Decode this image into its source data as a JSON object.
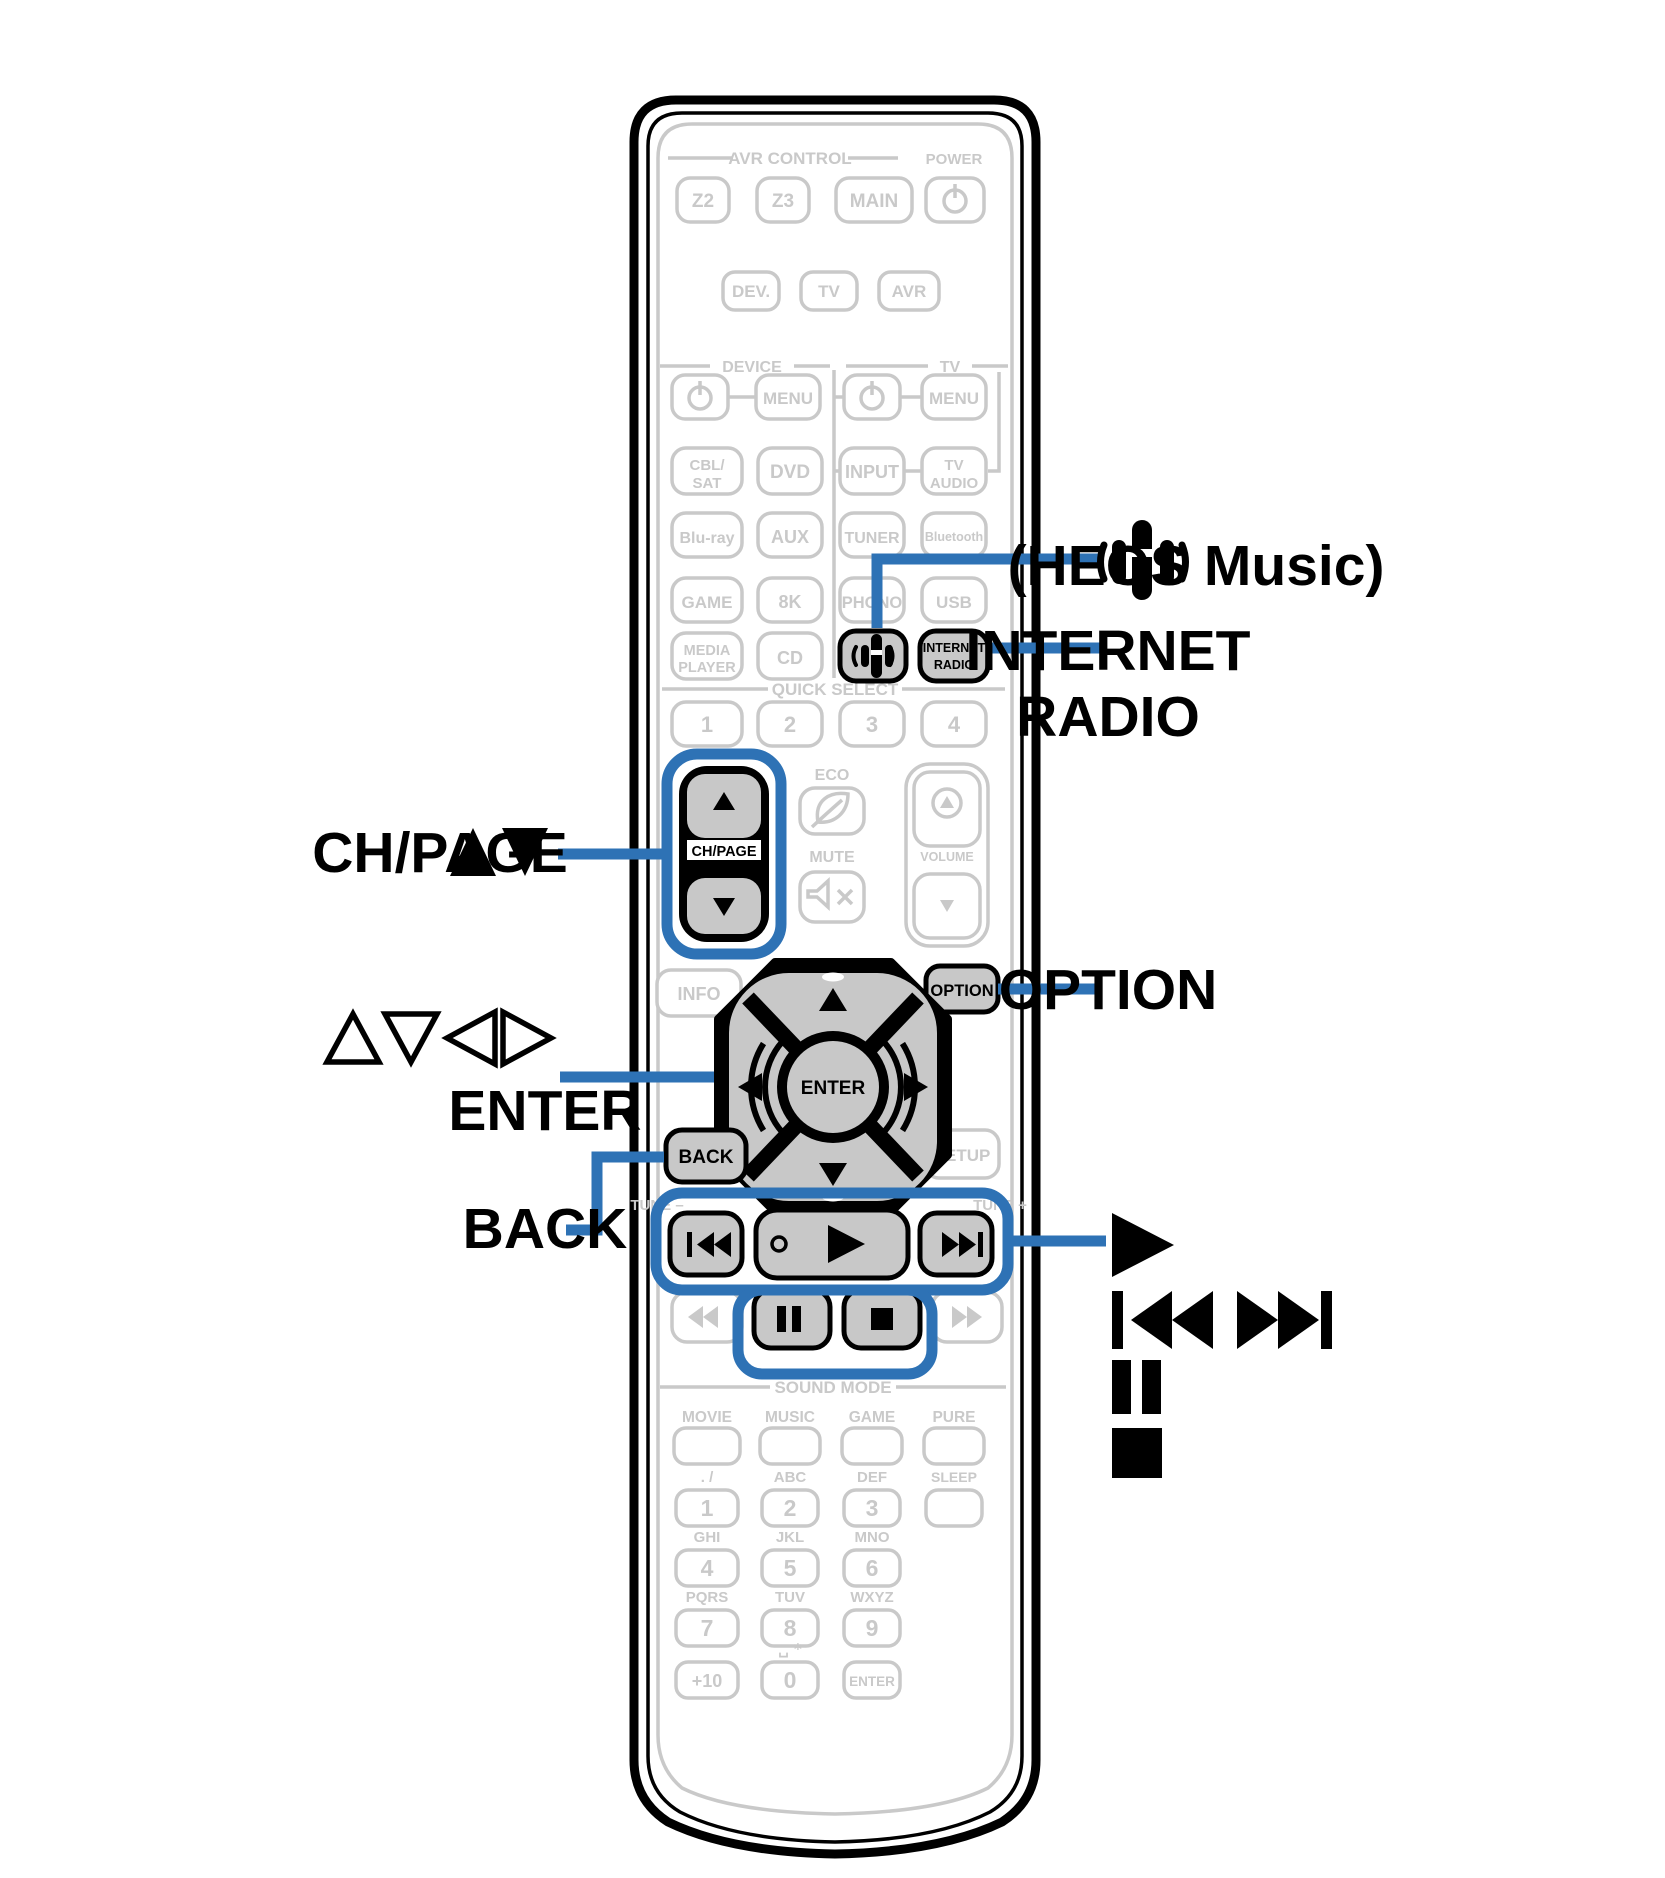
{
  "colors": {
    "accent_blue": "#2E72B5",
    "inactive_gray": "#C9C9C9",
    "key_fill": "#C8C8C8",
    "ink": "#000000"
  },
  "callouts": {
    "ch_page": "CH/PAGE",
    "enter": "ENTER",
    "back": "BACK",
    "heos": "(HEOS Music)",
    "internet_line1": "INTERNET",
    "internet_line2": "RADIO",
    "option": "OPTION"
  },
  "glyphs": {
    "ch_page_arrows": "▲▼",
    "cursor_arrows": "△▽◁▷",
    "play": "▶",
    "skip_back": "⏮",
    "skip_forward": "⏭",
    "pause": "⏸",
    "stop": "⏹"
  },
  "remote": {
    "avr_control": {
      "title": "AVR CONTROL",
      "z2": "Z2",
      "z3": "Z3",
      "main": "MAIN",
      "power": "POWER"
    },
    "mode_buttons": {
      "dev": "DEV.",
      "tv": "TV",
      "avr": "AVR"
    },
    "sections": {
      "device": "DEVICE",
      "tv": "TV"
    },
    "grid": {
      "menu_device": "MENU",
      "menu_tv": "MENU",
      "cbl_line1": "CBL/",
      "cbl_line2": "SAT",
      "dvd": "DVD",
      "input": "INPUT",
      "tv_audio_line1": "TV",
      "tv_audio_line2": "AUDIO",
      "bluray": "Blu-ray",
      "aux": "AUX",
      "tuner": "TUNER",
      "bluetooth": "Bluetooth",
      "game": "GAME",
      "k8": "8K",
      "phono": "PHONO",
      "usb": "USB",
      "media_line1": "MEDIA",
      "media_line2": "PLAYER",
      "cd": "CD",
      "internet_line1": "INTERNET",
      "internet_line2": "RADIO"
    },
    "quick_select": {
      "title": "QUICK SELECT",
      "q1": "1",
      "q2": "2",
      "q3": "3",
      "q4": "4"
    },
    "center": {
      "eco": "ECO",
      "ch_page": "CH/PAGE",
      "mute": "MUTE",
      "volume": "VOLUME",
      "info": "INFO",
      "option": "OPTION",
      "enter": "ENTER",
      "back": "BACK",
      "setup": "SETUP"
    },
    "transport": {
      "tune_minus": "TUNE –",
      "tune_plus": "TUNE +"
    },
    "sound_mode": {
      "title": "SOUND MODE",
      "movie": "MOVIE",
      "music": "MUSIC",
      "game": "GAME",
      "pure": "PURE"
    },
    "keypad": {
      "slash": ". /",
      "abc": "ABC",
      "def": "DEF",
      "sleep": "SLEEP",
      "ghi": "GHI",
      "jkl": "JKL",
      "mno": "MNO",
      "pqrs": "PQRS",
      "tuv": "TUV",
      "wxyz": "WXYZ",
      "n1": "1",
      "n2": "2",
      "n3": "3",
      "n4": "4",
      "n5": "5",
      "n6": "6",
      "n7": "7",
      "n8": "8",
      "n9": "9",
      "n0": "0",
      "space_star": "␣ *",
      "plus10": "+10",
      "enter": "ENTER"
    }
  }
}
